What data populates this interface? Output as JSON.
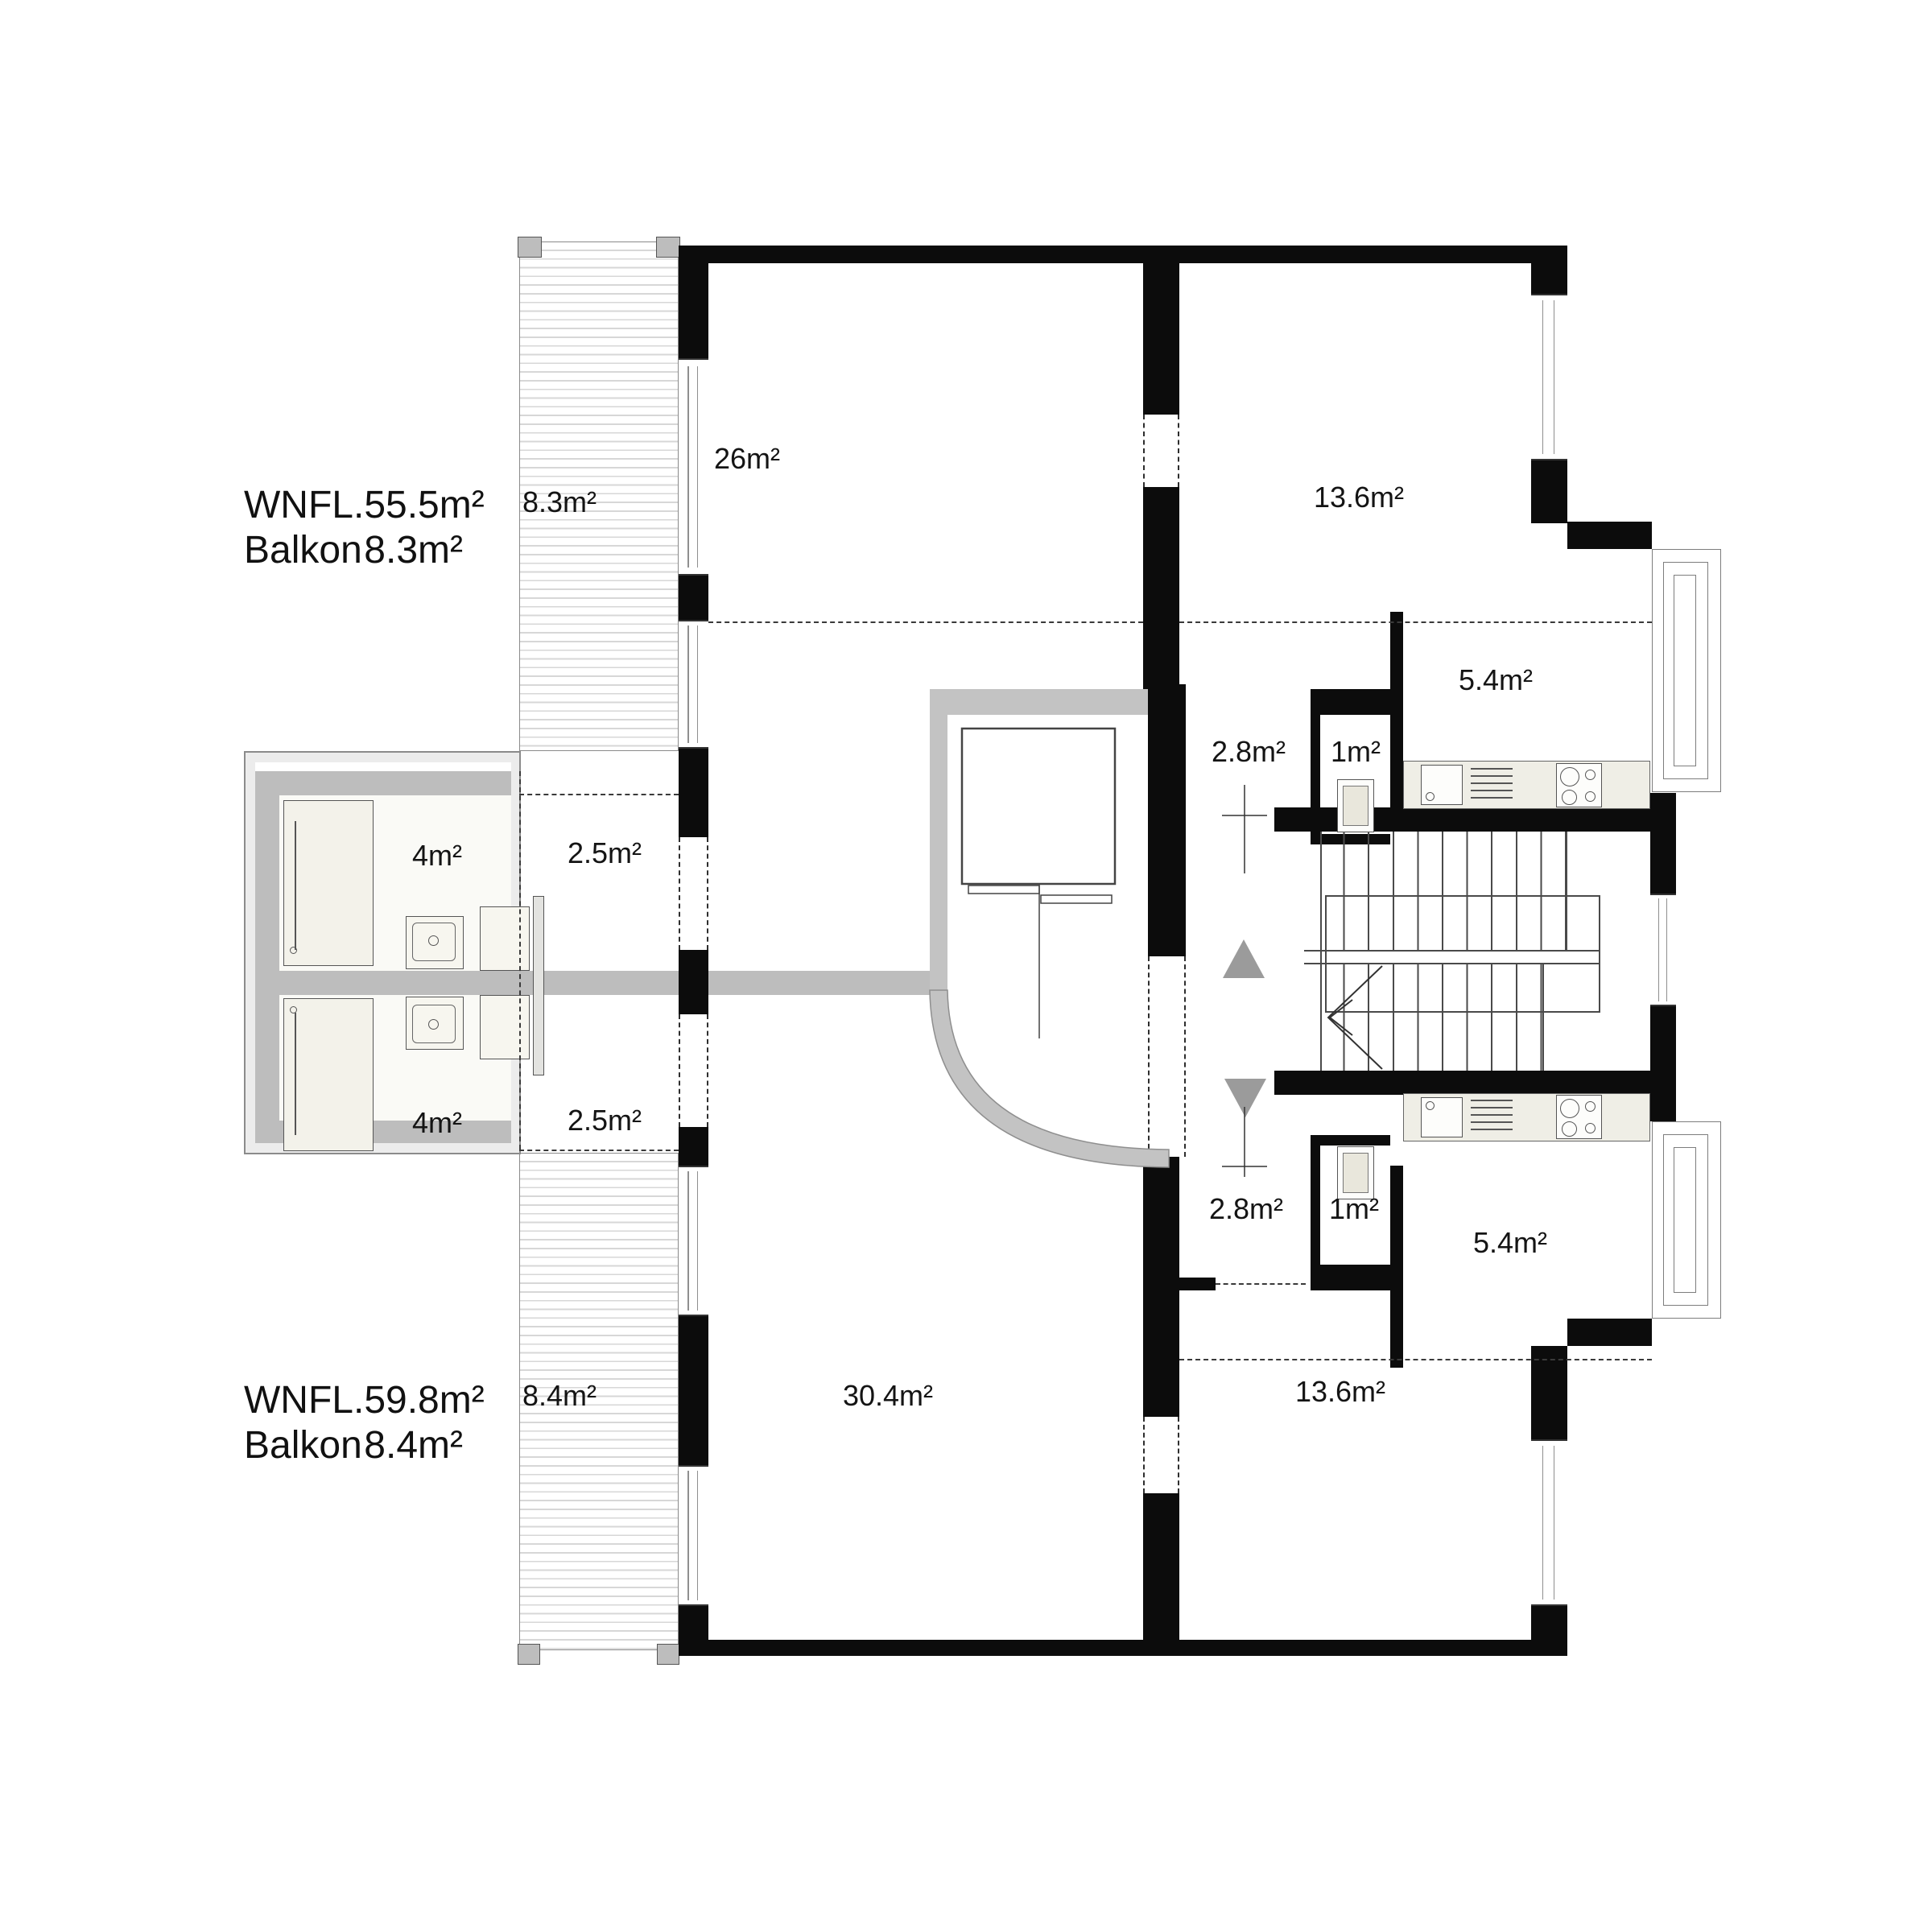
{
  "title_blocks": {
    "top": {
      "row1_label": "WNFL.",
      "row1_value": "55.5m²",
      "row2_label": "Balkon",
      "row2_value": "8.3m²"
    },
    "bottom": {
      "row1_label": "WNFL.",
      "row1_value": "59.8m²",
      "row2_label": "Balkon",
      "row2_value": "8.4m²"
    }
  },
  "rooms": {
    "balcony_top": {
      "name": "balcony",
      "area": "8.3m²"
    },
    "living_top": {
      "name": "room",
      "area": "26m²"
    },
    "bedroom_top": {
      "name": "room",
      "area": "13.6m²"
    },
    "kitchen_top": {
      "name": "kitchen",
      "area": "5.4m²"
    },
    "hall_top": {
      "name": "hall",
      "area": "2.8m²"
    },
    "wc_top": {
      "name": "wc",
      "area": "1m²"
    },
    "bath_top": {
      "name": "bathroom",
      "area": "4m²"
    },
    "vestibule_top": {
      "name": "vestibule",
      "area": "2.5m²"
    },
    "bath_bottom": {
      "name": "bathroom",
      "area": "4m²"
    },
    "vestibule_bottom": {
      "name": "vestibule",
      "area": "2.5m²"
    },
    "hall_bottom": {
      "name": "hall",
      "area": "2.8m²"
    },
    "wc_bottom": {
      "name": "wc",
      "area": "1m²"
    },
    "kitchen_bottom": {
      "name": "kitchen",
      "area": "5.4m²"
    },
    "balcony_bottom": {
      "name": "balcony",
      "area": "8.4m²"
    },
    "living_bottom": {
      "name": "living room",
      "area": "30.4m²"
    },
    "bedroom_bottom": {
      "name": "room",
      "area": "13.6m²"
    }
  },
  "colors": {
    "wall": "#0c0c0c",
    "gray_wall": "#c3c3c3",
    "pod_wall": "#bdbdbd",
    "hatch_line": "#d7d7d7",
    "counter": "#efeee6",
    "arrow_gray": "#9b9b9b"
  }
}
